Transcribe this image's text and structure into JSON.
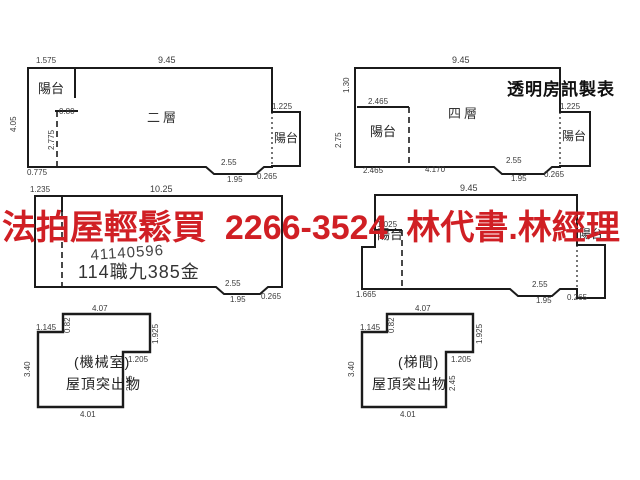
{
  "ad": {
    "text": "法拍屋輕鬆買  2266-3524  林代書.林經理",
    "color": "#d01f24"
  },
  "watermark": "透明房訊製表",
  "stamp": {
    "line1": "41140596",
    "line2": "114職九385金"
  },
  "plans": {
    "p1": {
      "name": "二層",
      "balcony_left": "陽台",
      "balcony_right": "陽台",
      "dims": {
        "top_left": "1.575",
        "top": "9.45",
        "left": "4.05",
        "inner_width": "0.80",
        "inner_height": "2.775",
        "bottom_left": "0.775",
        "balcony_right_top": "1.225",
        "notch": "2.55",
        "notch_bottom": "1.95",
        "notch_right": "0.265"
      }
    },
    "p2": {
      "name": "四層",
      "balcony_left": "陽台",
      "balcony_right": "陽台",
      "dims": {
        "top": "9.45",
        "left_top": "1.30",
        "left": "2.75",
        "balcony_top": "2.465",
        "balcony_bottom": "2.465",
        "bottom_mid": "4.170",
        "balcony_right_top": "1.225",
        "notch": "2.55",
        "notch_bottom": "1.95",
        "notch_right": "0.265"
      }
    },
    "p3": {
      "dims": {
        "top_left": "1.235",
        "top": "10.25",
        "notch": "2.55",
        "notch_bottom": "1.95",
        "notch_right": "0.265"
      }
    },
    "p4": {
      "balcony_left": "陽台",
      "balcony_right": "陽台",
      "dims": {
        "top": "9.45",
        "balcony_top": "1.025",
        "balcony_bottom": "1.665",
        "notch": "2.55",
        "notch_bottom": "1.95",
        "notch_right": "0.265"
      }
    },
    "p5": {
      "name": "(機械室)",
      "sub": "屋頂突出物",
      "dims": {
        "top": "4.07",
        "left_notch": "1.145",
        "notch_height": "0.82",
        "left": "3.40",
        "right": "1.925",
        "step": "1.205",
        "step_height": "2.45",
        "bottom": "4.01"
      }
    },
    "p6": {
      "name": "(梯間)",
      "sub": "屋頂突出物",
      "dims": {
        "top": "4.07",
        "left_notch": "1.145",
        "notch_height": "0.82",
        "left": "3.40",
        "right": "1.925",
        "step": "1.205",
        "step_height": "2.45",
        "bottom": "4.01"
      }
    }
  }
}
